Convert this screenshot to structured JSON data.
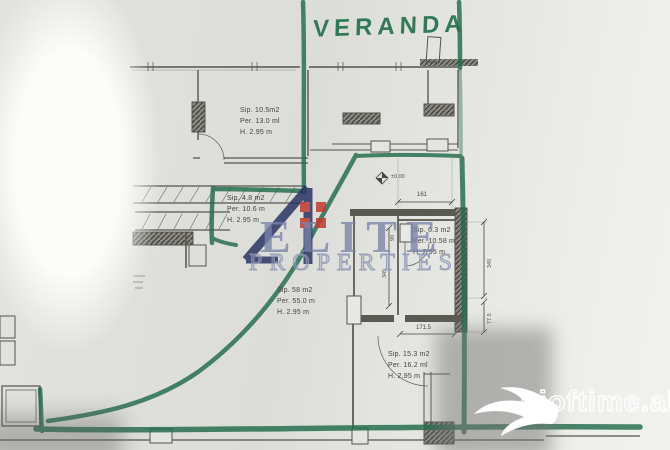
{
  "annotations": {
    "veranda_label": "VERANDA"
  },
  "rooms": [
    {
      "id": "room-10-5",
      "area": "Sip. 10.5m2",
      "perimeter": "Per. 13.0 ml",
      "height": "H. 2.95 m"
    },
    {
      "id": "room-4-8",
      "area": "Sip. 4.8 m2",
      "perimeter": "Per. 10.6 m",
      "height": "H. 2.95 m"
    },
    {
      "id": "room-6-3",
      "area": "Sip. 6.3 m2",
      "perimeter": "Per. 10.58 m",
      "height": "H. 2.95 m"
    },
    {
      "id": "room-58",
      "area": "Sip. 58 m2",
      "perimeter": "Per. 55.0 m",
      "height": "H. 2.95 m"
    },
    {
      "id": "room-15-3",
      "area": "Sip. 15.3 m2",
      "perimeter": "Per. 16.2 ml",
      "height": "H. 2.95 m"
    }
  ],
  "dimensions": {
    "top_width": "161",
    "bottom_width": "171.5",
    "door_width": "90",
    "interior_height": "345",
    "right_upper": "345",
    "right_lower": "77.5",
    "level_marker": "±0.00"
  },
  "watermark": {
    "brand": "ELITE",
    "tagline": "PROPERTIES"
  },
  "site_logo": {
    "text": "njoftime.al"
  },
  "colors": {
    "marker_green": "#226b4a",
    "paper": "#e2e3df",
    "plan_line": "#55544e",
    "watermark_blue": "#7883a8",
    "logo_navy": "#2a3563",
    "logo_red": "#c03a2f"
  }
}
